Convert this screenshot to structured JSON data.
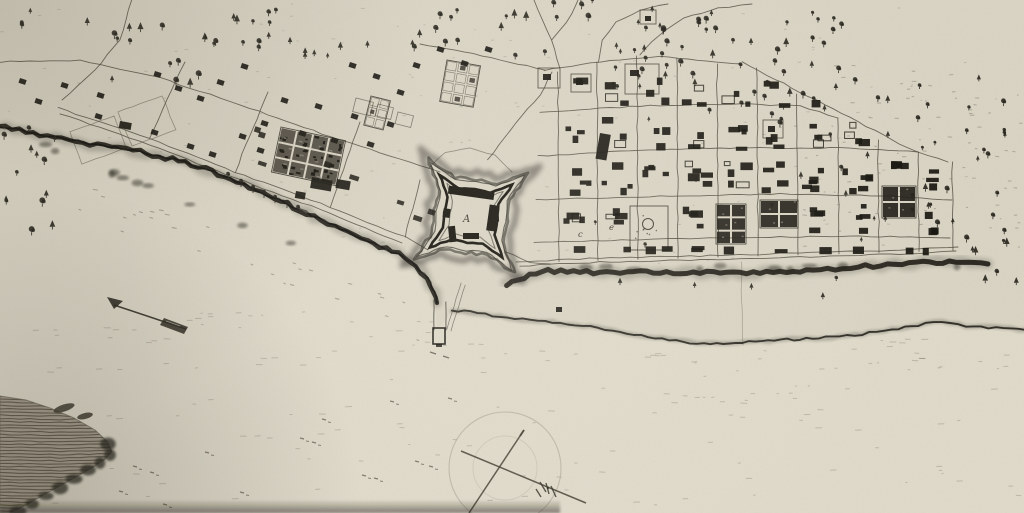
{
  "palette": {
    "paper": "#dad5c5",
    "ink_dark": "#17150f",
    "ink_mid": "#2e2b23",
    "ink_faint": "#6e6a5c",
    "bank_ink": "#14120c",
    "water_tint": "#eeeadb"
  },
  "labels": {
    "fort_label": "A",
    "block_label_1": "c",
    "block_label_2": "e"
  },
  "icons": {
    "north_arrow": "north-arrow-icon",
    "compass_rose": "compass-rose-icon"
  }
}
